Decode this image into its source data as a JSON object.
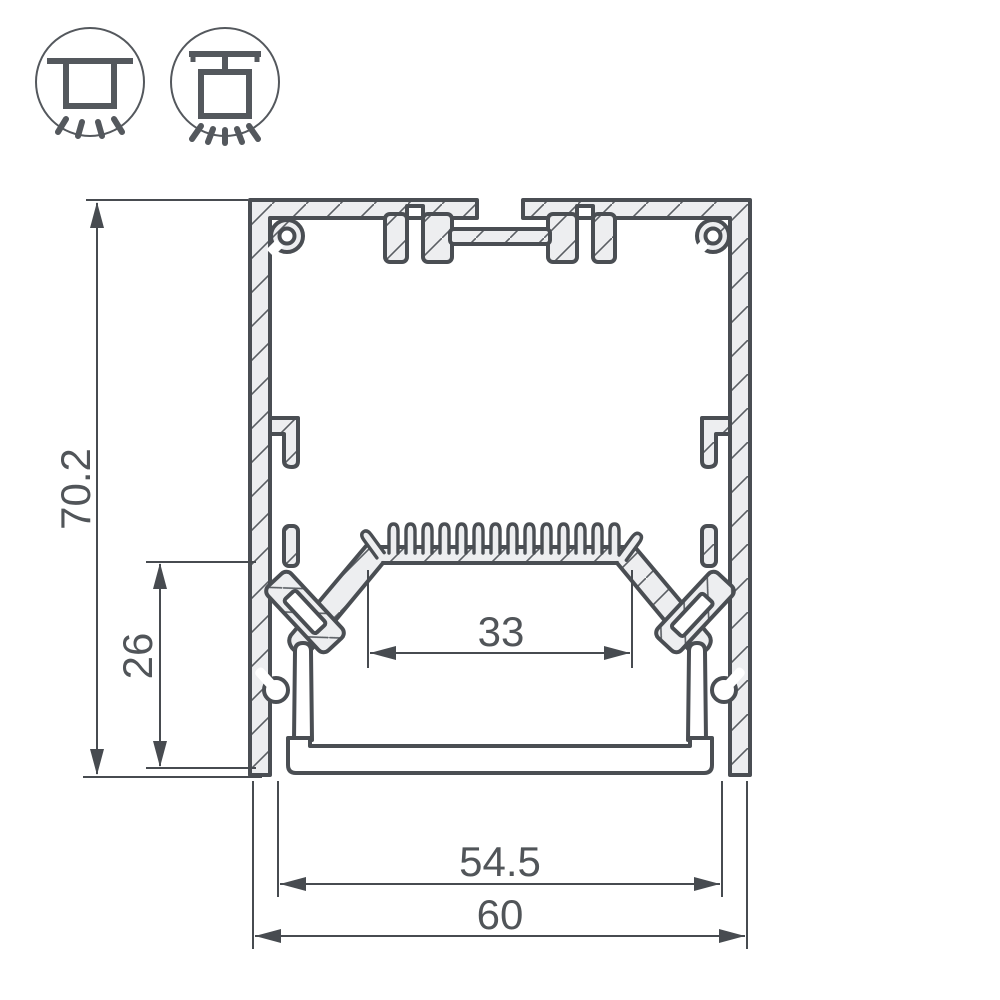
{
  "drawing": {
    "type": "aluminum-led-profile-cross-section",
    "dimensions": {
      "overall_height": "70.2",
      "inner_height": "26",
      "led_shelf_width": "33",
      "inner_width": "54.5",
      "overall_width": "60"
    },
    "icons": [
      {
        "name": "surface-mount-luminaire-icon",
        "meaning": "ceiling surface mounting"
      },
      {
        "name": "pendant-luminaire-icon",
        "meaning": "suspended / pendant mounting"
      }
    ],
    "colors": {
      "background": "#ffffff",
      "outline": "#4a4e53",
      "aluminum_fill": "#edeef0",
      "hatch_line": "#5a5e63",
      "dimension_line": "#474b50",
      "dimension_text": "#515559"
    }
  }
}
